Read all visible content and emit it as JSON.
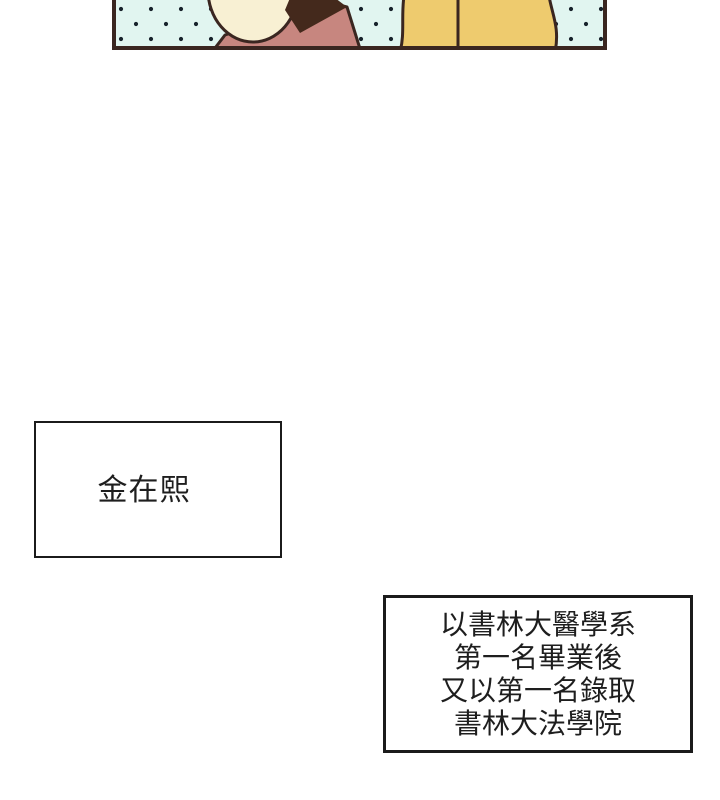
{
  "panel": {
    "colors": {
      "background": "#e1f5f0",
      "dots": "#17222b",
      "outline": "#3a2620",
      "border": "#3a2620",
      "face_skin": "#f8f0d3",
      "dark_hair": "#44291c",
      "shirt": "#c7867f",
      "blonde_hair": "#eecb6e"
    }
  },
  "name_box": {
    "text": "金在熙"
  },
  "caption_box": {
    "lines": [
      "以書林大醫學系",
      "第一名畢業後",
      "又以第一名錄取",
      "書林大法學院"
    ]
  }
}
